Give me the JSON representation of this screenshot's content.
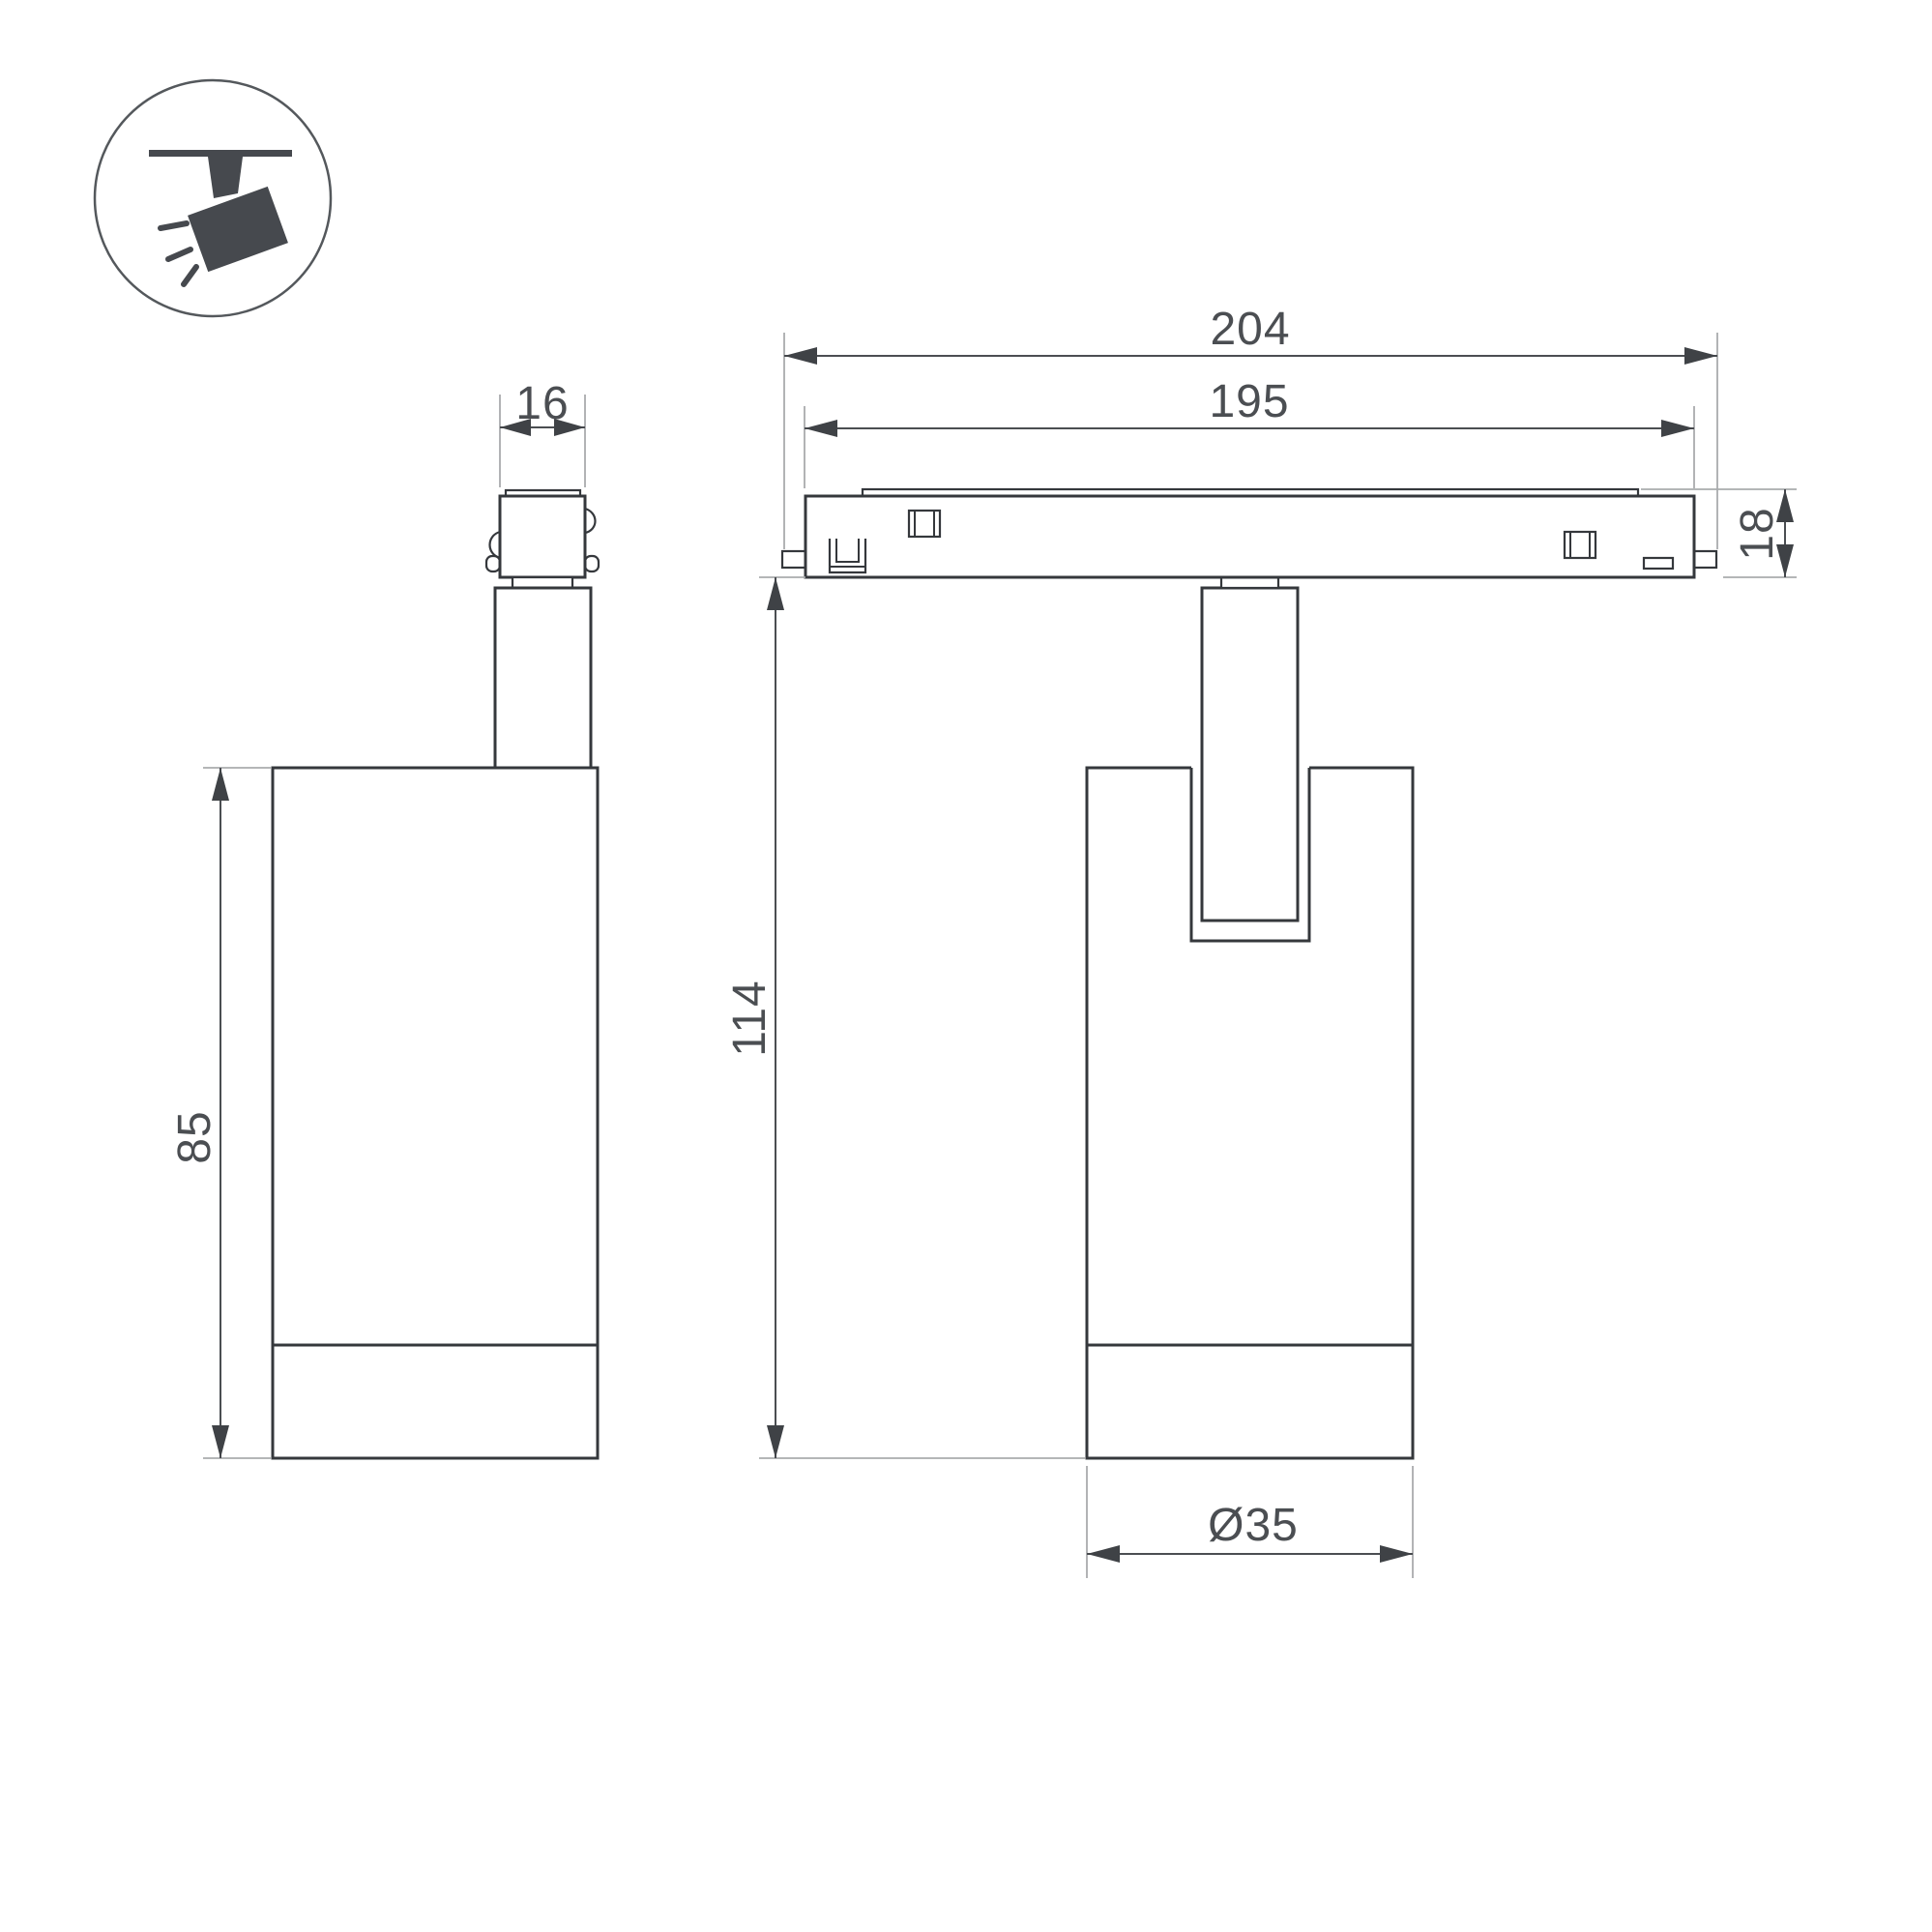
{
  "drawing": {
    "type": "technical-dimension-drawing",
    "subject": "magnetic track spotlight luminaire, two orthographic views"
  },
  "icon": {
    "name": "track-spotlight-icon",
    "depicts": "angled spotlight hanging from ceiling track with light rays"
  },
  "dimensions": {
    "adapter_width": "16",
    "track_overall_length": "204",
    "track_body_length": "195",
    "track_height": "18",
    "luminaire_body_height": "85",
    "overall_height": "114",
    "body_diameter": "Ø35"
  },
  "colors": {
    "outline": "#35383c",
    "dimension": "#4b4e52",
    "extension_line": "#a9abad",
    "icon_fill": "#46494e",
    "background": "#ffffff"
  }
}
